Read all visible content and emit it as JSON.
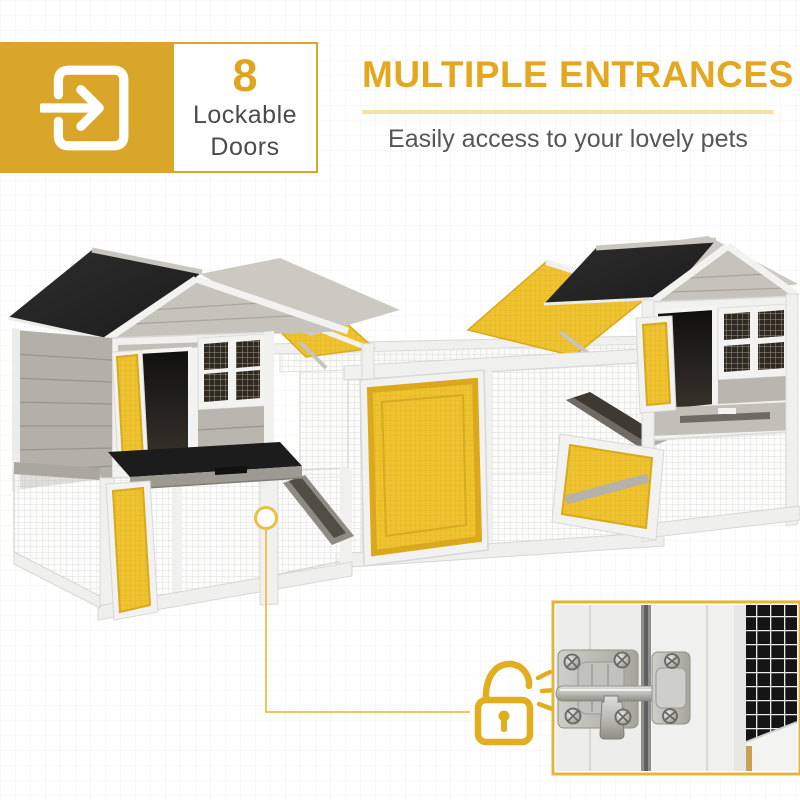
{
  "header": {
    "stat_badge": {
      "icon": "door-enter-icon",
      "count": "8",
      "label_line1": "Lockable",
      "label_line2": "Doors",
      "box_color": "#DAA62A",
      "count_color": "#DFA51F"
    },
    "title": "MULTIPLE ENTRANCES",
    "title_color": "#E3A81F",
    "underline_color": "#F5E2A0",
    "subtitle": "Easily access to your lovely pets",
    "subtitle_color": "#55565A"
  },
  "illustration": {
    "name": "double-hutch-product-photo",
    "colors": {
      "roof_black": "#242424",
      "frame_white": "#F1F1EF",
      "wood_gray": "#B3AFA9",
      "door_yellow": "#EFC22F",
      "door_yellow_border": "#D9A91F",
      "accent_yellow": "#E2AE1E"
    }
  },
  "callout": {
    "marker_icon": "circle-marker",
    "lock_icon": "open-padlock-icon",
    "line_color": "#EAC043",
    "inset": {
      "name": "door-latch-closeup-photo",
      "border_color": "#E3B63A"
    }
  }
}
